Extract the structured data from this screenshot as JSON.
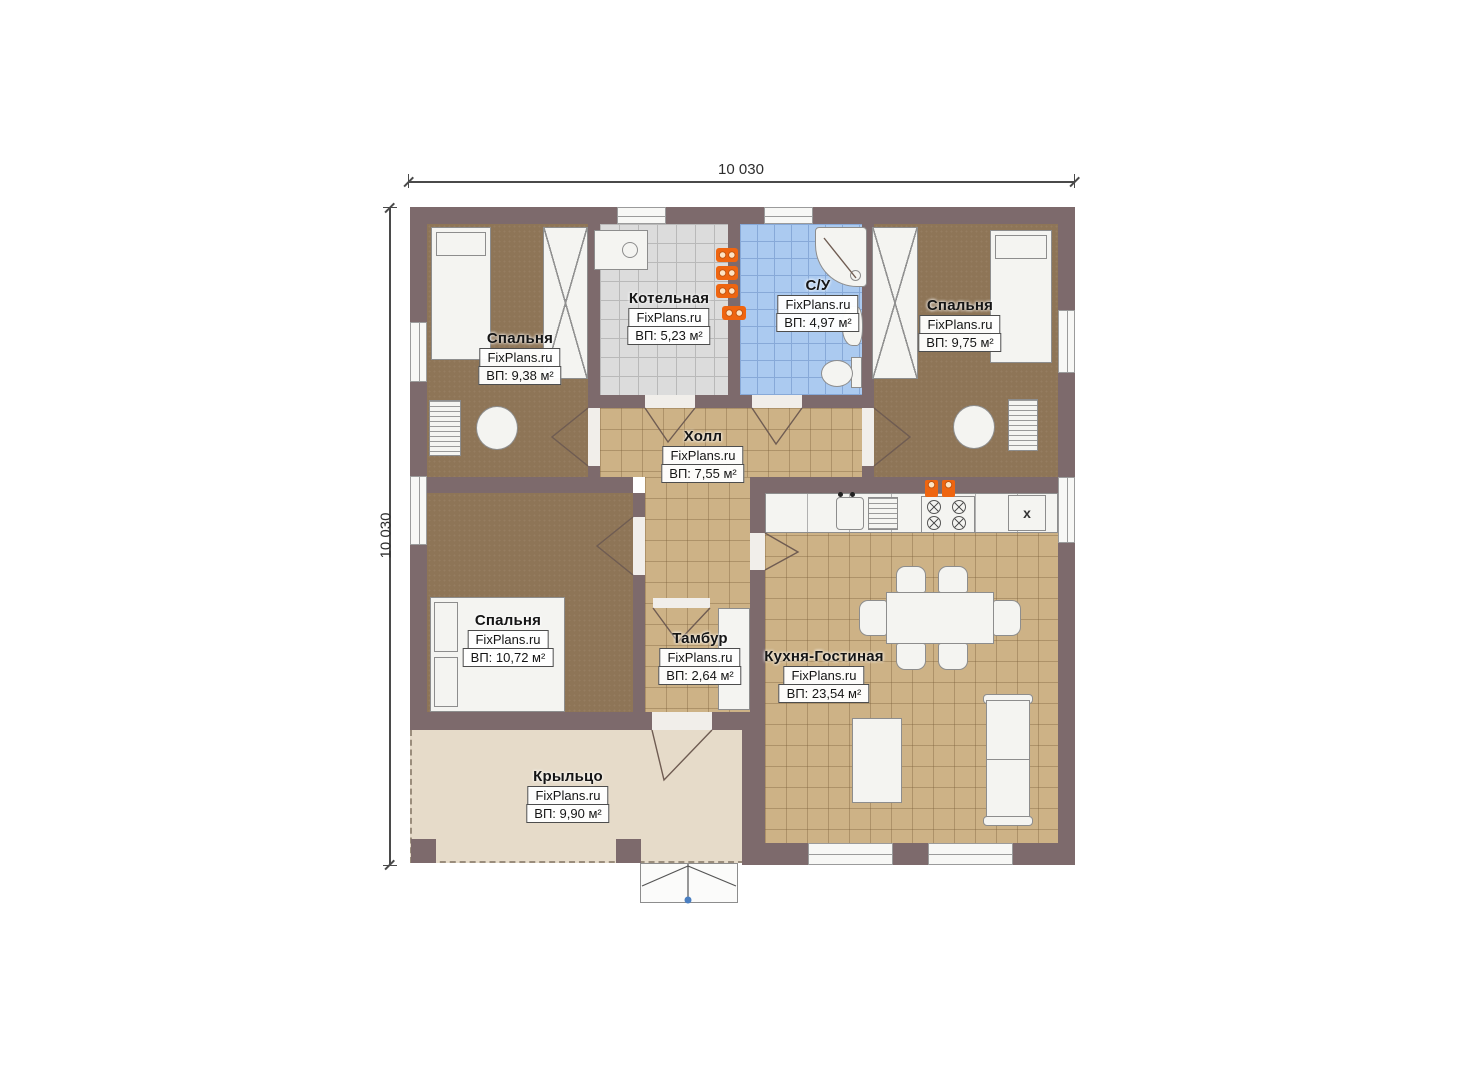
{
  "dimensions": {
    "top_label": "10 030",
    "left_label": "10 030"
  },
  "rooms": [
    {
      "id": "bedroom-top-left",
      "name": "Спальня",
      "brand": "FixPlans.ru",
      "area": "ВП: 9,38 м²"
    },
    {
      "id": "boiler-room",
      "name": "Котельная",
      "brand": "FixPlans.ru",
      "area": "ВП: 5,23 м²"
    },
    {
      "id": "bathroom",
      "name": "С/У",
      "brand": "FixPlans.ru",
      "area": "ВП: 4,97 м²"
    },
    {
      "id": "bedroom-top-right",
      "name": "Спальня",
      "brand": "FixPlans.ru",
      "area": "ВП: 9,75 м²"
    },
    {
      "id": "hall",
      "name": "Холл",
      "brand": "FixPlans.ru",
      "area": "ВП: 7,55 м²"
    },
    {
      "id": "bedroom-bottom-left",
      "name": "Спальня",
      "brand": "FixPlans.ru",
      "area": "ВП: 10,72 м²"
    },
    {
      "id": "vestibule",
      "name": "Тамбур",
      "brand": "FixPlans.ru",
      "area": "ВП: 2,64 м²"
    },
    {
      "id": "kitchen-living",
      "name": "Кухня-Гостиная",
      "brand": "FixPlans.ru",
      "area": "ВП: 23,54 м²"
    },
    {
      "id": "porch",
      "name": "Крыльцо",
      "brand": "FixPlans.ru",
      "area": "ВП: 9,90 м²"
    }
  ],
  "kitchen": {
    "fridge_marker": "x"
  },
  "palette": {
    "wall": "#7d6a6c",
    "bedroom_floor": "#8e7557",
    "tile_floor": "#cdb286",
    "boiler_floor": "#dcdcdc",
    "bathroom_floor": "#abcaf0",
    "porch_floor": "#e6dbc9",
    "furniture": "#f4f4f1",
    "accent_orange": "#ef6510",
    "dimension_text": "#2e2e2e"
  }
}
